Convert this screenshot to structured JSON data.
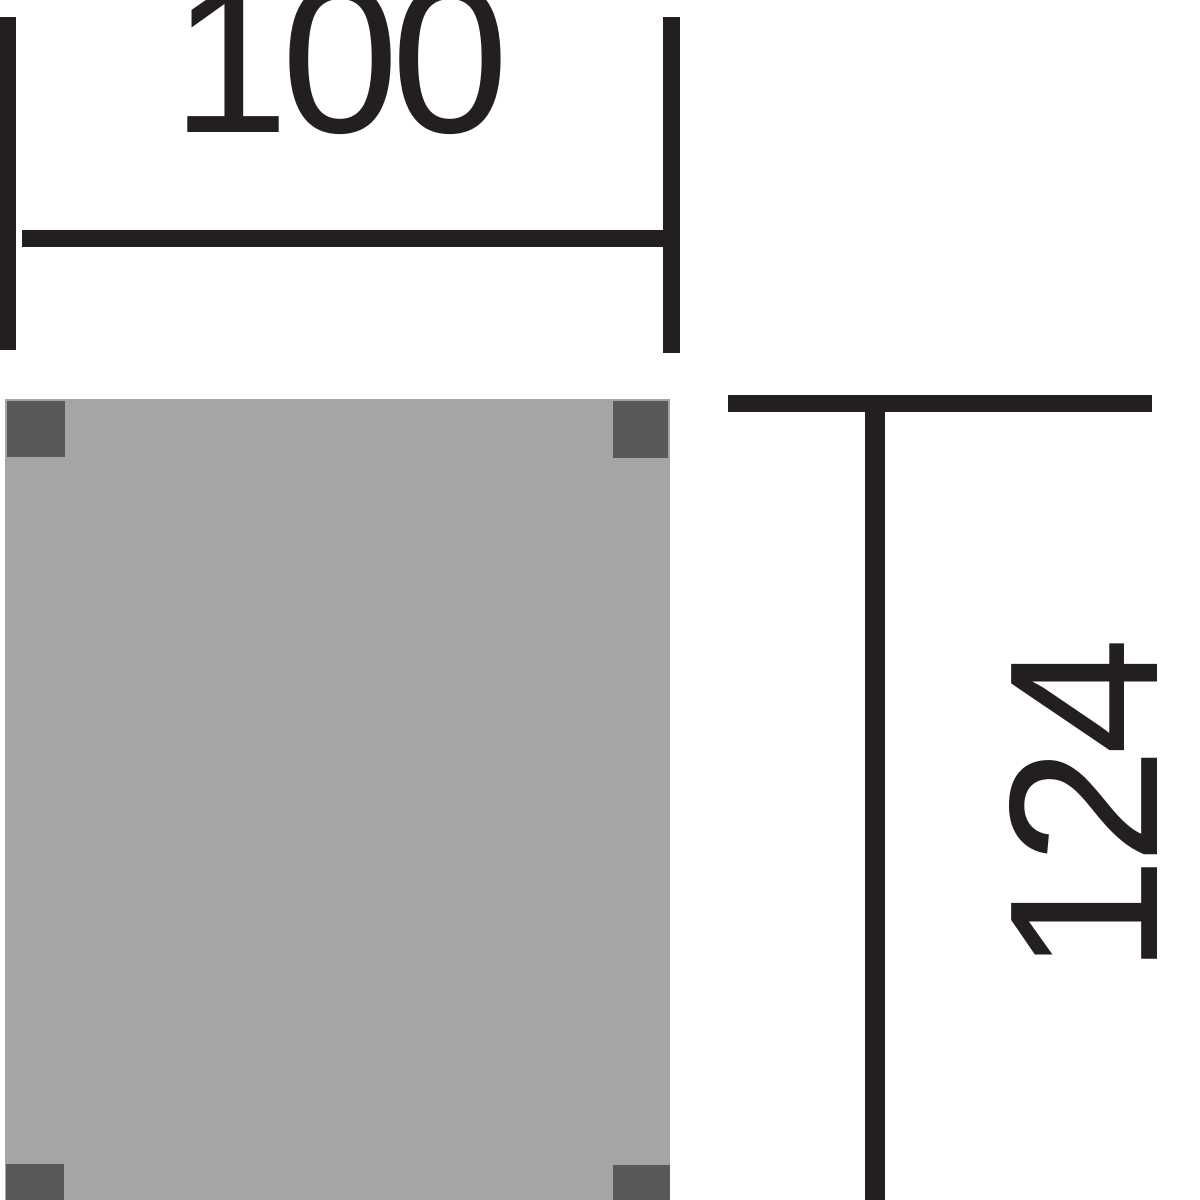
{
  "drawing": {
    "width_dimension": {
      "label": "100"
    },
    "height_dimension": {
      "label": "124"
    },
    "colors": {
      "ink": "#231f20",
      "panel_fill": "#a4a5a7",
      "post_fill": "#58595b",
      "background": "#ffffff"
    }
  }
}
